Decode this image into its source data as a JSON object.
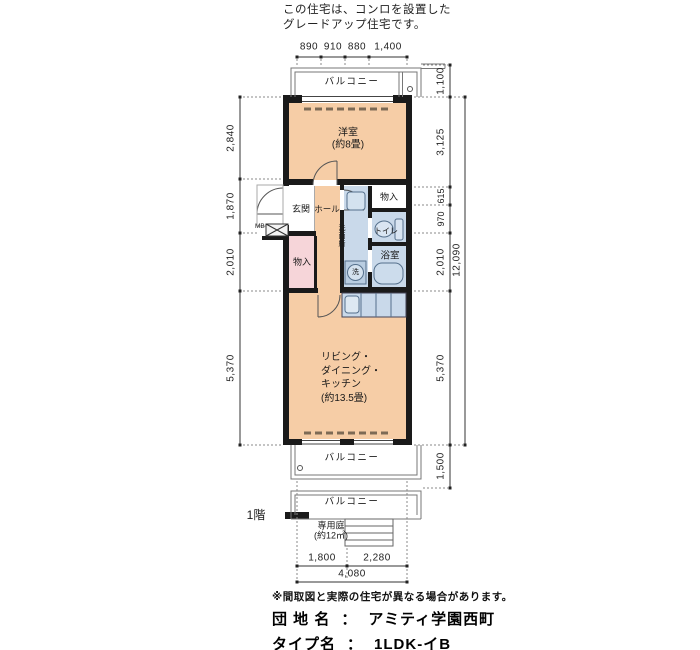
{
  "header": {
    "note_line1": "この住宅は、コンロを設置した",
    "note_line2": "グレードアップ住宅です。"
  },
  "plan": {
    "floor_label": "1階",
    "rooms": {
      "western": {
        "name": "洋室",
        "size": "(約8畳)"
      },
      "entrance": "玄関",
      "hall": "ホール",
      "closet_hall": "物入",
      "closet_upper": "物入",
      "washroom": "洗面所",
      "toilet": "トイレ",
      "bath": "浴室",
      "washer_symbol": "洗",
      "meter_box": "MB",
      "ldk": {
        "line1": "リビング・",
        "line2": "ダイニング・",
        "line3": "キッチン",
        "size": "(約13.5畳)"
      },
      "balcony_top": "バルコニー",
      "balcony_bottom": "バルコニー",
      "balcony_1f": "バルコニー",
      "garden": {
        "name": "専用庭",
        "size": "(約12㎡)"
      }
    },
    "dimensions": {
      "top": [
        "890",
        "910",
        "880",
        "1,400"
      ],
      "left": [
        "2,840",
        "1,870",
        "2,010",
        "5,370"
      ],
      "right": [
        "1,100",
        "3,125",
        "615",
        "970",
        "2,010",
        "5,370",
        "1,500"
      ],
      "right_total": "12,090",
      "bottom": [
        "1,800",
        "2,280"
      ],
      "bottom_total": "4,080"
    },
    "colors": {
      "room_fill": "#f6cda6",
      "water_fill": "#c9d9ea",
      "storage_fill": "#f6d5d9",
      "wall": "#1a1a1a"
    }
  },
  "footer": {
    "disclaimer": "※間取図と実際の住宅が異なる場合があります。",
    "estate": {
      "label": "団 地 名",
      "colon": "：",
      "value": "アミティ学園西町"
    },
    "type": {
      "label": "タイプ名",
      "colon": "：",
      "value": "1LDK-イB"
    }
  }
}
